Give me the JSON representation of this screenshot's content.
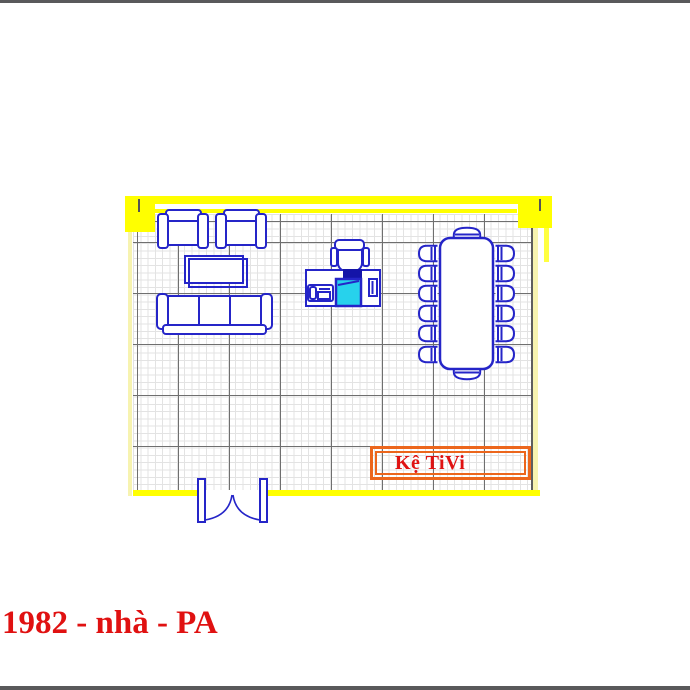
{
  "window": {
    "background": "#ffffff",
    "frame_bar_color": "#59595b"
  },
  "caption": {
    "text": "1982 - nhà - PA",
    "color": "#e01111"
  },
  "floor_plan": {
    "type": "furniture-layout-plan",
    "wall_color": "#ffff00",
    "wall_accent_color": "#f7f3b0",
    "line_color": "#2525c8",
    "grid": {
      "minor_color": "#e3e3e3",
      "major_color": "#6f6f6f"
    },
    "tv_shelf": {
      "label": "Kệ TiVi",
      "text_color": "#e01212",
      "border_color": "#ec661c"
    },
    "furniture": {
      "armchair_count": 2,
      "sofa_seat_count": 3,
      "coffee_table_count": 1,
      "desk": {
        "monitor_color": "#27d2ec",
        "keyboard_color": "#1414a8",
        "has_phone": true,
        "has_office_chair": true
      },
      "conference_table": {
        "chair_count": 14
      },
      "double_door_count": 1
    }
  }
}
